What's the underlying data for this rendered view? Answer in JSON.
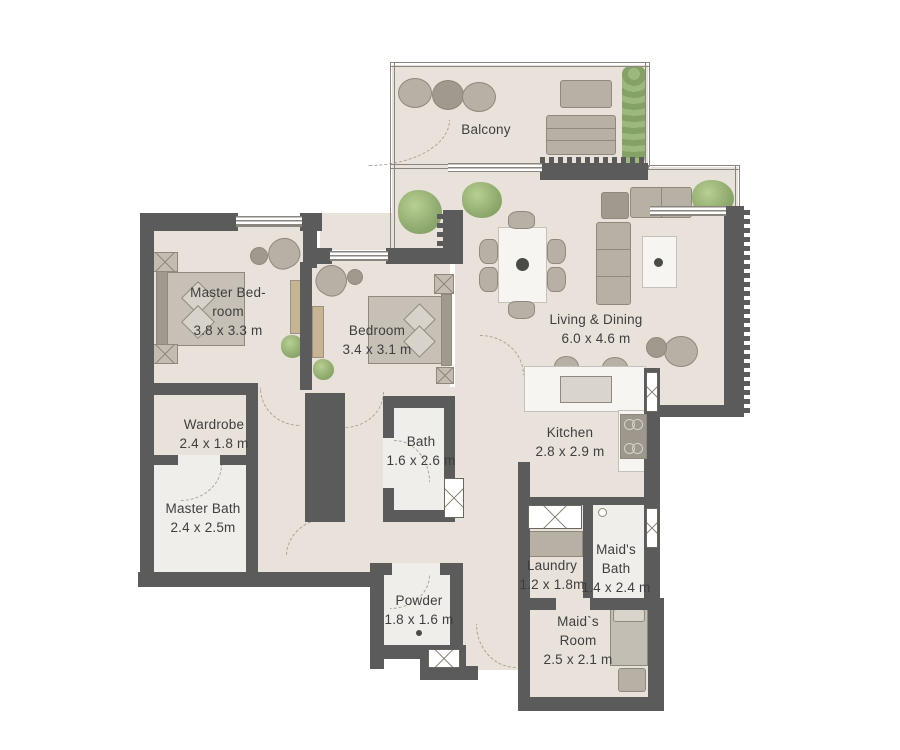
{
  "title": "Apartment floor plan",
  "colors": {
    "wall": "#5b5b5b",
    "floor": "#e8e2da",
    "wet_floor": "#f0eeea",
    "wood": "#c7b492",
    "furn": "#b7b1a5",
    "rug": "#b2a292",
    "green": "#93ad72",
    "marble": "#f7f5f1",
    "text": "#3e3e3e",
    "rail": "#8a857e"
  },
  "rooms": {
    "balcony": {
      "label": "Balcony"
    },
    "master_bedroom": {
      "line1": "Master Bed-",
      "line2": "room",
      "dims": "3.8 x 3.3 m"
    },
    "bedroom": {
      "label": "Bedroom",
      "dims": "3.4 x 3.1 m"
    },
    "living_dining": {
      "label": "Living & Dining",
      "dims": "6.0 x 4.6 m"
    },
    "wardrobe": {
      "label": "Wardrobe",
      "dims": "2.4 x 1.8 m"
    },
    "master_bath": {
      "label": "Master Bath",
      "dims": "2.4 x 2.5m"
    },
    "bath": {
      "label": "Bath",
      "dims": "1.6 x 2.6 m"
    },
    "kitchen": {
      "label": "Kitchen",
      "dims": "2.8 x 2.9 m"
    },
    "laundry": {
      "label": "Laundry",
      "dims": "1.2 x 1.8m"
    },
    "maids_bath": {
      "line1": "Maid's",
      "line2": "Bath",
      "dims": "1.4 x 2.4 m"
    },
    "powder": {
      "label": "Powder",
      "dims": "1.8 x 1.6 m"
    },
    "maids_room": {
      "line1": "Maid`s",
      "line2": "Room",
      "dims": "2.5 x 2.1 m"
    }
  }
}
